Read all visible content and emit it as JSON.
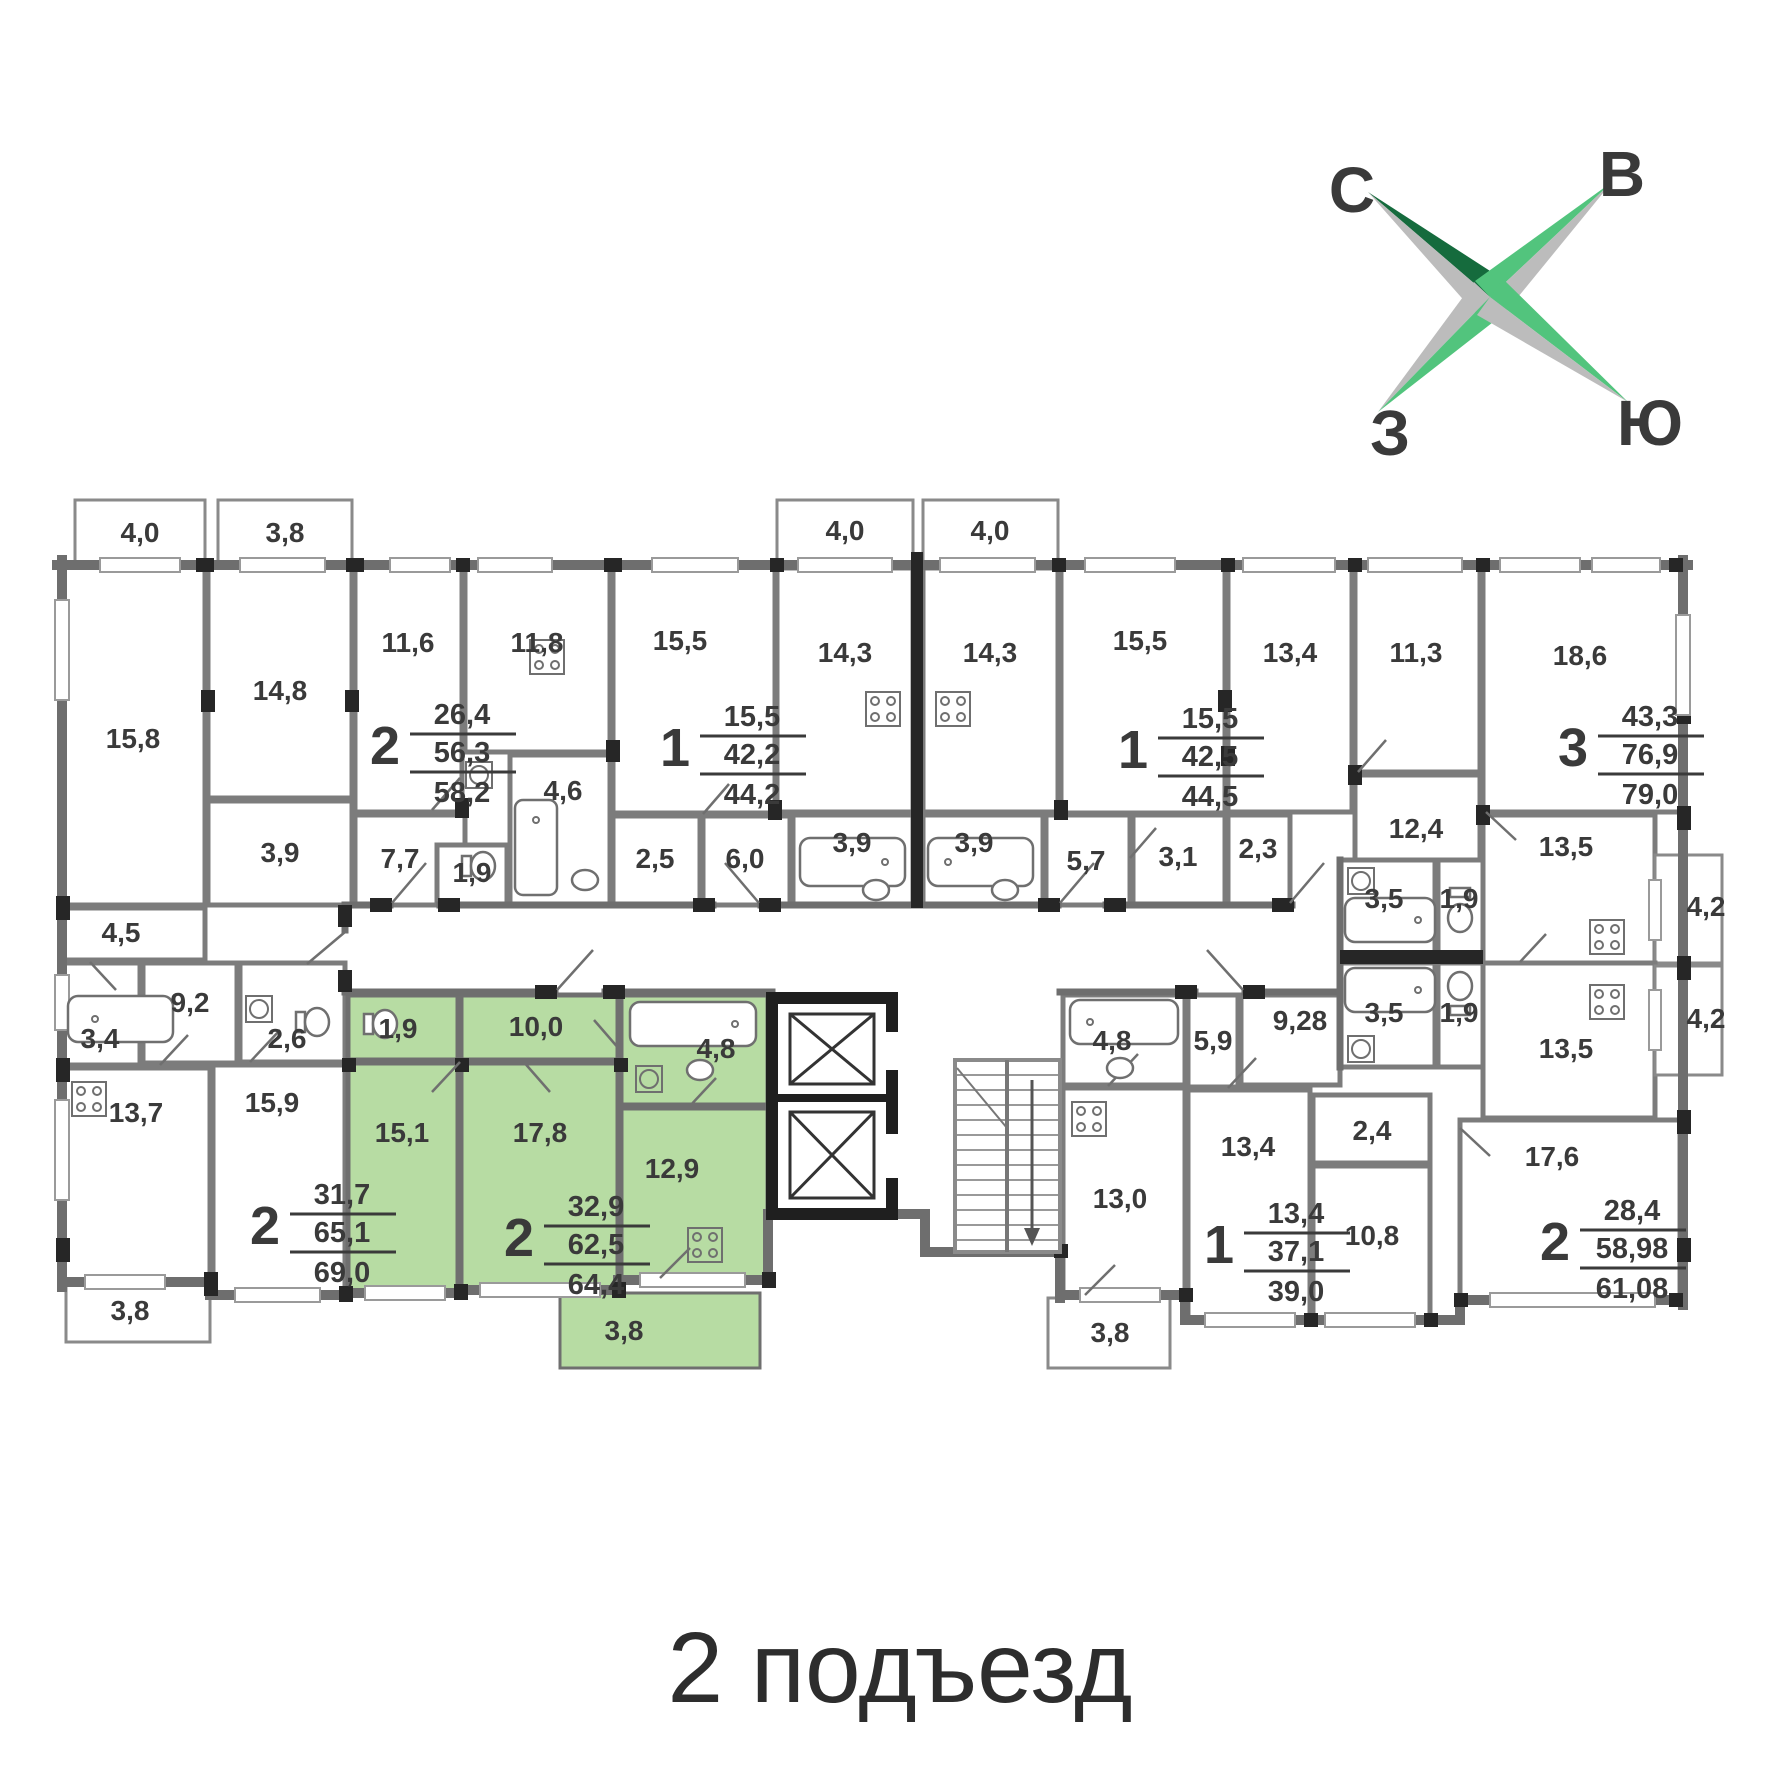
{
  "title": "2 подъезд",
  "compass": {
    "north": "С",
    "east": "В",
    "west": "З",
    "south": "Ю"
  },
  "colors": {
    "highlight_green": "#b7dca3",
    "wall_gray": "#6e6e6e",
    "accent_black": "#262626",
    "label": "#3a3a3a",
    "compass_dark_green": "#156b3d",
    "compass_light_green": "#52c47d",
    "compass_gray": "#bcbcbc",
    "compass_letter_gray": "#8e8e8e"
  },
  "plan": {
    "rooms": [
      {
        "area": "4,0",
        "x": 140,
        "y": 542
      },
      {
        "area": "3,8",
        "x": 285,
        "y": 542
      },
      {
        "area": "15,8",
        "x": 133,
        "y": 748
      },
      {
        "area": "14,8",
        "x": 280,
        "y": 700
      },
      {
        "area": "3,9",
        "x": 280,
        "y": 862
      },
      {
        "area": "11,6",
        "x": 408,
        "y": 652
      },
      {
        "area": "11,8",
        "x": 537,
        "y": 652
      },
      {
        "area": "7,7",
        "x": 400,
        "y": 868
      },
      {
        "area": "1,9",
        "x": 472,
        "y": 882
      },
      {
        "area": "4,6",
        "x": 563,
        "y": 800
      },
      {
        "area": "15,5",
        "x": 680,
        "y": 650
      },
      {
        "area": "2,5",
        "x": 655,
        "y": 868
      },
      {
        "area": "6,0",
        "x": 745,
        "y": 868
      },
      {
        "area": "4,0",
        "x": 845,
        "y": 540
      },
      {
        "area": "14,3",
        "x": 845,
        "y": 662
      },
      {
        "area": "3,9",
        "x": 852,
        "y": 852
      },
      {
        "area": "4,0",
        "x": 990,
        "y": 540
      },
      {
        "area": "14,3",
        "x": 990,
        "y": 662
      },
      {
        "area": "3,9",
        "x": 974,
        "y": 852
      },
      {
        "area": "5,7",
        "x": 1086,
        "y": 870
      },
      {
        "area": "15,5",
        "x": 1140,
        "y": 650
      },
      {
        "area": "3,1",
        "x": 1178,
        "y": 866
      },
      {
        "area": "2,3",
        "x": 1258,
        "y": 858
      },
      {
        "area": "13,4",
        "x": 1290,
        "y": 662
      },
      {
        "area": "11,3",
        "x": 1416,
        "y": 662
      },
      {
        "area": "12,4",
        "x": 1416,
        "y": 838
      },
      {
        "area": "18,6",
        "x": 1580,
        "y": 665
      },
      {
        "area": "13,5",
        "x": 1566,
        "y": 856
      },
      {
        "area": "3,5",
        "x": 1384,
        "y": 908
      },
      {
        "area": "1,9",
        "x": 1459,
        "y": 908
      },
      {
        "area": "4,2",
        "x": 1706,
        "y": 916
      },
      {
        "area": "3,5",
        "x": 1384,
        "y": 1022
      },
      {
        "area": "1,9",
        "x": 1459,
        "y": 1022
      },
      {
        "area": "13,5",
        "x": 1566,
        "y": 1058
      },
      {
        "area": "4,2",
        "x": 1706,
        "y": 1028
      },
      {
        "area": "4,5",
        "x": 121,
        "y": 942
      },
      {
        "area": "9,2",
        "x": 190,
        "y": 1012
      },
      {
        "area": "3,4",
        "x": 100,
        "y": 1048
      },
      {
        "area": "2,6",
        "x": 287,
        "y": 1048
      },
      {
        "area": "13,7",
        "x": 136,
        "y": 1122
      },
      {
        "area": "15,9",
        "x": 272,
        "y": 1112
      },
      {
        "area": "1,9",
        "x": 398,
        "y": 1038,
        "green": true
      },
      {
        "area": "10,0",
        "x": 536,
        "y": 1036,
        "green": true
      },
      {
        "area": "15,1",
        "x": 402,
        "y": 1142,
        "green": true
      },
      {
        "area": "17,8",
        "x": 540,
        "y": 1142,
        "green": true
      },
      {
        "area": "4,8",
        "x": 716,
        "y": 1058,
        "green": true
      },
      {
        "area": "12,9",
        "x": 672,
        "y": 1178,
        "green": true
      },
      {
        "area": "3,8",
        "x": 624,
        "y": 1340,
        "green": true
      },
      {
        "area": "3,8",
        "x": 130,
        "y": 1320
      },
      {
        "area": "4,8",
        "x": 1112,
        "y": 1050
      },
      {
        "area": "5,9",
        "x": 1213,
        "y": 1050
      },
      {
        "area": "9,28",
        "x": 1300,
        "y": 1030
      },
      {
        "area": "13,0",
        "x": 1120,
        "y": 1208
      },
      {
        "area": "13,4",
        "x": 1248,
        "y": 1156
      },
      {
        "area": "2,4",
        "x": 1372,
        "y": 1140
      },
      {
        "area": "10,8",
        "x": 1372,
        "y": 1245
      },
      {
        "area": "3,8",
        "x": 1110,
        "y": 1342
      },
      {
        "area": "17,6",
        "x": 1552,
        "y": 1166
      }
    ],
    "apartments": [
      {
        "rooms": "2",
        "living": "26,4",
        "total": "56,3",
        "total_with_balcony": "58,2",
        "x": 400,
        "y": 746,
        "green": false
      },
      {
        "rooms": "1",
        "living": "15,5",
        "total": "42,2",
        "total_with_balcony": "44,2",
        "x": 690,
        "y": 748,
        "green": false
      },
      {
        "rooms": "1",
        "living": "15,5",
        "total": "42,5",
        "total_with_balcony": "44,5",
        "x": 1148,
        "y": 750,
        "green": false
      },
      {
        "rooms": "3",
        "living": "43,3",
        "total": "76,9",
        "total_with_balcony": "79,0",
        "x": 1588,
        "y": 748,
        "green": false
      },
      {
        "rooms": "2",
        "living": "31,7",
        "total": "65,1",
        "total_with_balcony": "69,0",
        "x": 280,
        "y": 1226,
        "green": false
      },
      {
        "rooms": "2",
        "living": "32,9",
        "total": "62,5",
        "total_with_balcony": "64,4",
        "x": 534,
        "y": 1238,
        "green": true
      },
      {
        "rooms": "1",
        "living": "13,4",
        "total": "37,1",
        "total_with_balcony": "39,0",
        "x": 1234,
        "y": 1245,
        "green": false
      },
      {
        "rooms": "2",
        "living": "28,4",
        "total": "58,98",
        "total_with_balcony": "61,08",
        "x": 1570,
        "y": 1242,
        "green": false
      }
    ]
  }
}
